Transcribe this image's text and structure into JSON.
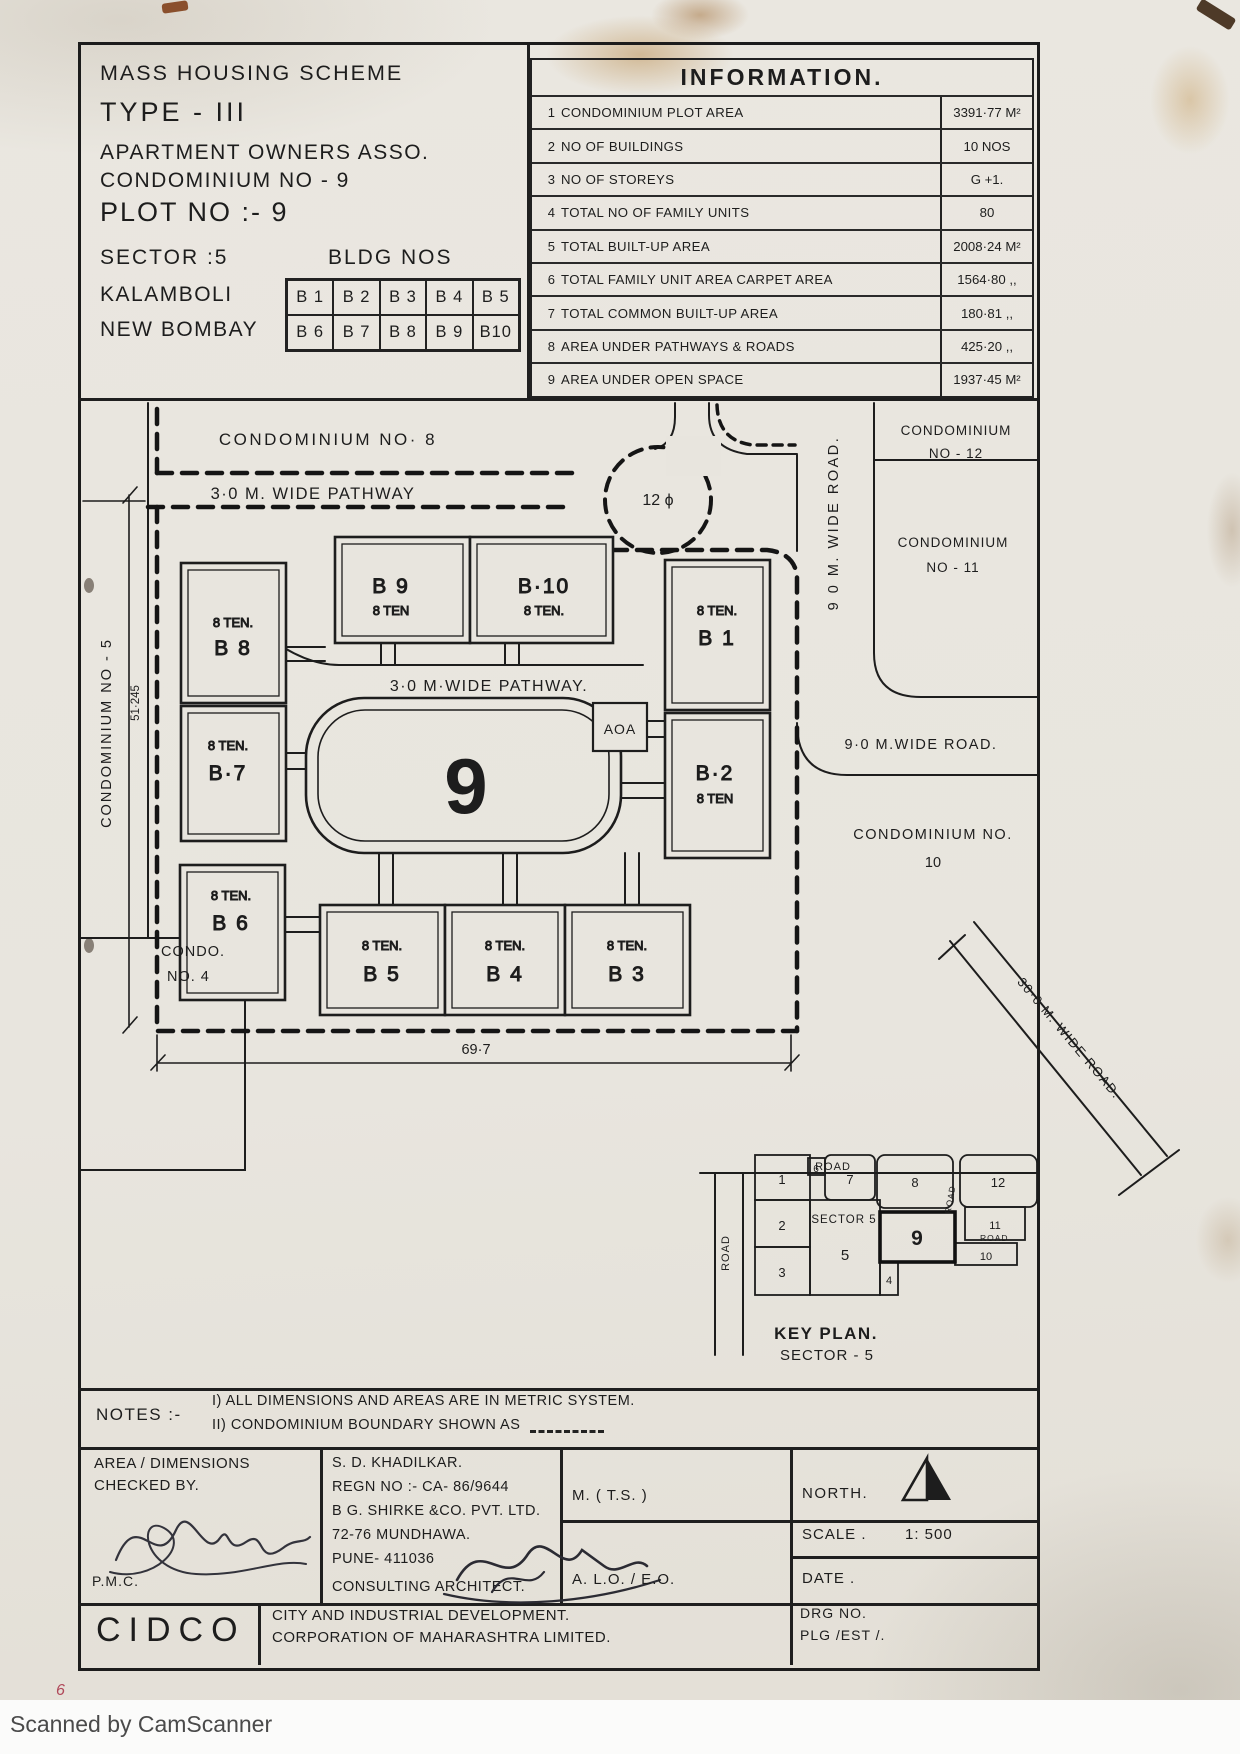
{
  "header": {
    "scheme": "MASS HOUSING SCHEME",
    "type": "TYPE - III",
    "asso": "APARTMENT OWNERS ASSO.",
    "condominium": "CONDOMINIUM NO - 9",
    "plot": "PLOT NO :- 9",
    "sector": "SECTOR  :5",
    "bldg_nos_label": "BLDG NOS",
    "city1": "KALAMBOLI",
    "city2": "NEW BOMBAY",
    "bldg_row1": [
      "B 1",
      "B 2",
      "B 3",
      "B 4",
      "B 5"
    ],
    "bldg_row2": [
      "B 6",
      "B 7",
      "B 8",
      "B 9",
      "B10"
    ]
  },
  "information": {
    "title": "INFORMATION.",
    "rows": [
      {
        "no": "1",
        "label": "CONDOMINIUM  PLOT  AREA",
        "value": "3391·77 M²"
      },
      {
        "no": "2",
        "label": "NO OF  BUILDINGS",
        "value": "10 NOS"
      },
      {
        "no": "3",
        "label": "NO OF  STOREYS",
        "value": "G +1."
      },
      {
        "no": "4",
        "label": "TOTAL   NO OF  FAMILY  UNITS",
        "value": "80"
      },
      {
        "no": "5",
        "label": "TOTAL  BUILT-UP  AREA",
        "value": "2008·24 M²"
      },
      {
        "no": "6",
        "label": "TOTAL FAMILY UNIT AREA   CARPET AREA",
        "value": "1564·80 ,,"
      },
      {
        "no": "7",
        "label": "TOTAL  COMMON  BUILT-UP  AREA",
        "value": "180·81 ,,"
      },
      {
        "no": "8",
        "label": "AREA  UNDER  PATHWAYS   &  ROADS",
        "value": "425·20 ,,"
      },
      {
        "no": "9",
        "label": "AREA  UNDER   OPEN SPACE",
        "value": "1937·45 M²"
      }
    ]
  },
  "site": {
    "condo8": "CONDOMINIUM  NO· 8",
    "pathway_top": "3·0 M. WIDE  PATHWAY",
    "culdesac": "12 ϕ",
    "road_right_v": "9 0  M. WIDE  ROAD.",
    "condo12_l1": "CONDOMINIUM",
    "condo12_l2": "NO - 12",
    "condo11_l1": "CONDOMINIUM",
    "condo11_l2": "NO - 11",
    "road_right_h": "9·0  M.WIDE  ROAD.",
    "condo10_l1": "CONDOMINIUM  NO.",
    "condo10_l2": "10",
    "condo5_v": "CONDOMINIUM  NO - 5",
    "dim_v": "51·245",
    "condo4_l1": "CONDO.",
    "condo4_l2": "NO. 4",
    "pathway_inner": "3·0  M·WIDE  PATHWAY.",
    "plot_no": "9",
    "aoa": "AOA",
    "dim_h": "69·7",
    "buildings": {
      "b8": {
        "ten": "8 TEN.",
        "name": "B 8"
      },
      "b7": {
        "ten": "8 TEN.",
        "name": "B·7"
      },
      "b6": {
        "ten": "8 TEN.",
        "name": "B 6"
      },
      "b9": {
        "ten": "8 TEN",
        "name": "B 9"
      },
      "b10": {
        "ten": "8 TEN.",
        "name": "B·10"
      },
      "b1": {
        "ten": "8 TEN.",
        "name": "B 1"
      },
      "b2": {
        "ten": "8 TEN",
        "name": "B·2"
      },
      "b5": {
        "ten": "8 TEN.",
        "name": "B 5"
      },
      "b4": {
        "ten": "8 TEN.",
        "name": "B 4"
      },
      "b3": {
        "ten": "8 TEN.",
        "name": "B 3"
      }
    }
  },
  "key_plan": {
    "title": "KEY PLAN.",
    "subtitle": "SECTOR - 5",
    "sector": "SECTOR 5",
    "road_top": "ROAD",
    "road_left": "ROAD",
    "road_mid": "ROAD",
    "road_small": "ROAD",
    "wide_road": "30·0  M.  WIDE  ROAD.",
    "cells": {
      "c1": "1",
      "c2": "2",
      "c3": "3",
      "c4": "4",
      "c5": "5",
      "c6": "6",
      "c7": "7",
      "c8": "8",
      "c9": "9",
      "c10": "10",
      "c11": "11",
      "c12": "12"
    }
  },
  "notes": {
    "label": "NOTES :-",
    "note1": "I)  ALL  DIMENSIONS  AND  AREAS  ARE    IN   METRIC  SYSTEM.",
    "note2": "II)  CONDOMINIUM  BOUNDARY  SHOWN   AS"
  },
  "titleblock": {
    "checked_l1": "AREA / DIMENSIONS",
    "checked_l2": "CHECKED  BY.",
    "pmc": "P.M.C.",
    "architect": [
      "S. D. KHADILKAR.",
      "REGN NO :- CA- 86/9644",
      "B  G. SHIRKE  &CO. PVT. LTD.",
      "72-76  MUNDHAWA.",
      "PUNE-  411036",
      "CONSULTING  ARCHITECT."
    ],
    "mts": "M. ( T.S. )",
    "alo": "A. L.O. / E.O.",
    "north": "NORTH.",
    "scale_label": "SCALE .",
    "scale_value": "1: 500",
    "date_label": "DATE .",
    "cidco": "CIDCO",
    "corp_l1": "CITY  AND  INDUSTRIAL  DEVELOPMENT.",
    "corp_l2": "CORPORATION  OF  MAHARASHTRA  LIMITED.",
    "drg_l1": "DRG NO.",
    "drg_l2": "PLG /EST /."
  },
  "margin_note": "6",
  "watermark": "Scanned by CamScanner"
}
